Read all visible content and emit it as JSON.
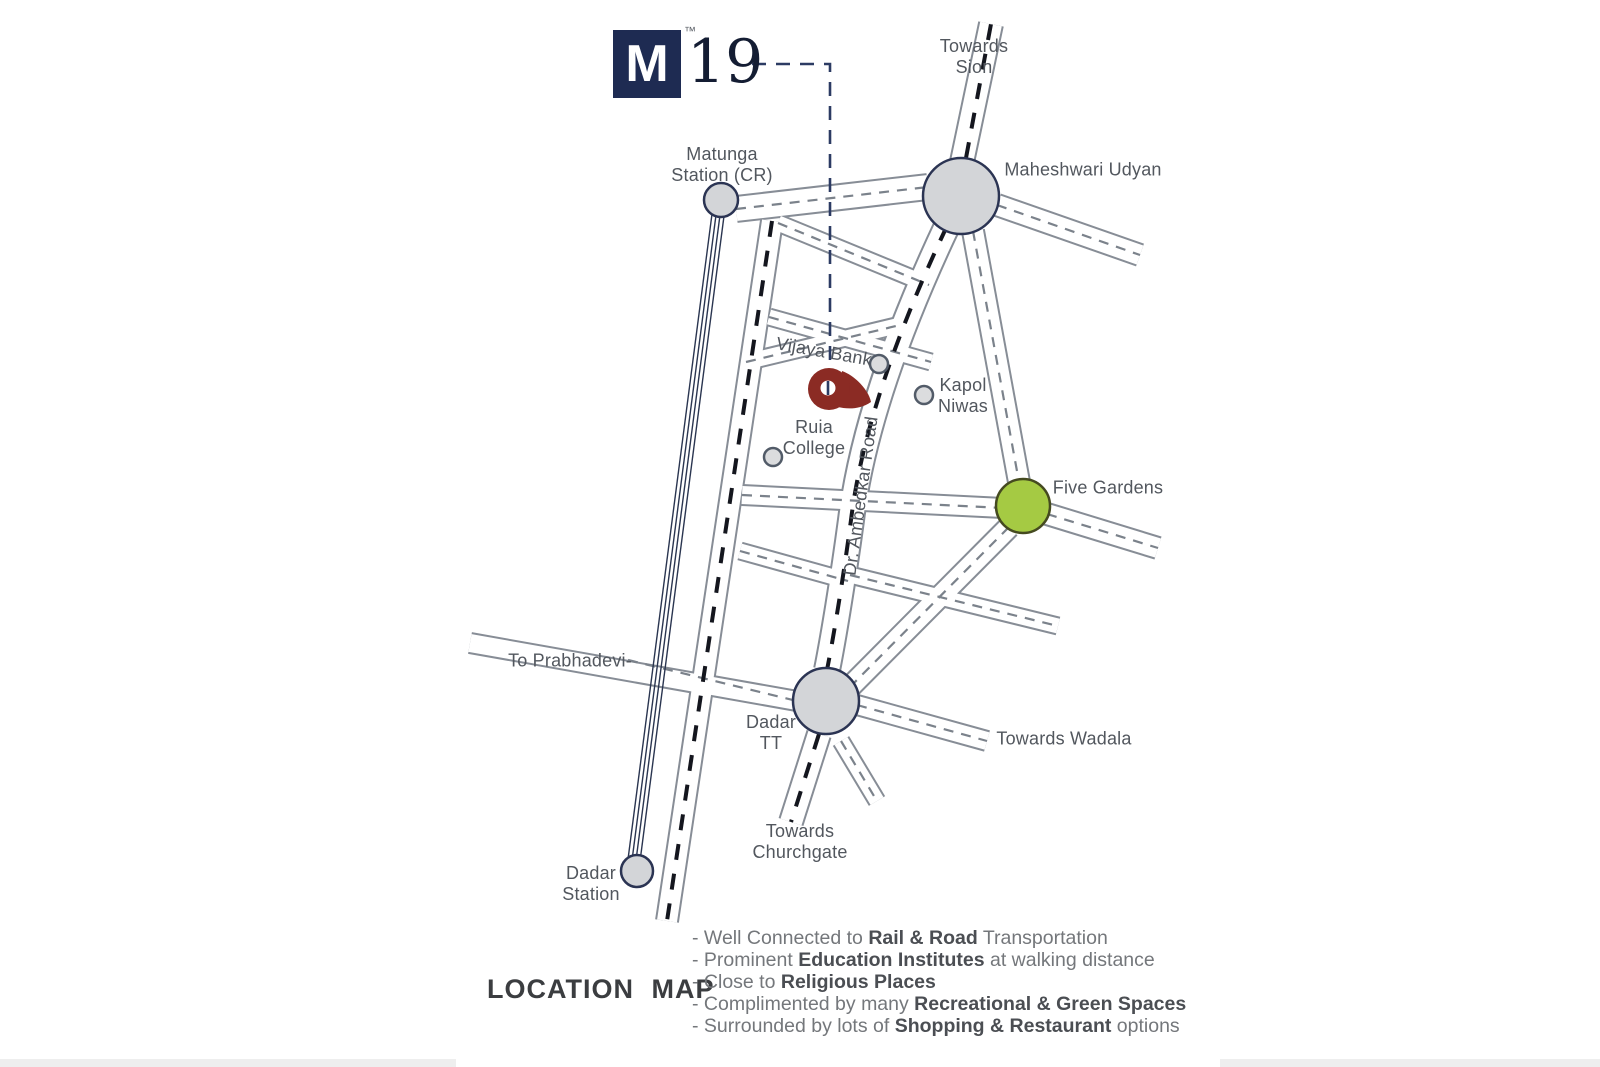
{
  "logo": {
    "m": "M",
    "tm": "™",
    "number": "19"
  },
  "map_labels": {
    "towards_sion": {
      "line1": "Towards",
      "line2": "Sion"
    },
    "matunga_station": {
      "line1": "Matunga",
      "line2": "Station (CR)"
    },
    "maheshwari_udyan": {
      "text": "Maheshwari Udyan"
    },
    "vijaya_bank": {
      "text": "Vijaya Bank"
    },
    "kapol_niwas": {
      "line1": "Kapol",
      "line2": "Niwas"
    },
    "ruia_college": {
      "line1": "Ruia",
      "line2": "College"
    },
    "ambedkar_road": {
      "text": "Dr. Ambedkar Road"
    },
    "five_gardens": {
      "text": "Five Gardens"
    },
    "to_prabhadevi": {
      "text": "To Prabhadevi-"
    },
    "dadar_tt": {
      "line1": "Dadar",
      "line2": "TT"
    },
    "towards_wadala": {
      "text": "Towards Wadala"
    },
    "towards_churchgate": {
      "line1": "Towards",
      "line2": "Churchgate"
    },
    "dadar_station": {
      "line1": "Dadar",
      "line2": "Station"
    }
  },
  "legend": {
    "title": "LOCATION MAP",
    "items": [
      {
        "segments": [
          {
            "t": "- Well Connected to ",
            "b": false
          },
          {
            "t": "Rail & Road",
            "b": true
          },
          {
            "t": " Transportation",
            "b": false
          }
        ]
      },
      {
        "segments": [
          {
            "t": "- Prominent ",
            "b": false
          },
          {
            "t": "Education Institutes",
            "b": true
          },
          {
            "t": " at walking distance",
            "b": false
          }
        ]
      },
      {
        "segments": [
          {
            "t": "- Close to ",
            "b": false
          },
          {
            "t": "Religious Places",
            "b": true
          }
        ]
      },
      {
        "segments": [
          {
            "t": "- Complimented by many ",
            "b": false
          },
          {
            "t": "Recreational & Green Spaces",
            "b": true
          }
        ]
      },
      {
        "segments": [
          {
            "t": "- Surrounded by lots of ",
            "b": false
          },
          {
            "t": "Shopping & Restaurant",
            "b": true
          },
          {
            "t": " options",
            "b": false
          }
        ]
      }
    ]
  },
  "colors": {
    "logo_navy": "#1e2b52",
    "pin_maroon": "#8b2b24",
    "node_gray_fill": "#d3d5d8",
    "node_navy_stroke": "#2b3453",
    "five_gardens_green": "#a5ca43",
    "road_casing_gray": "#878d96",
    "bold_dash_black": "#14161e",
    "thin_dash_gray": "#7b828b",
    "railway_navy": "#2a3550",
    "label_gray": "#52575e",
    "legend_text_gray": "#74777b",
    "legend_bold_gray": "#4b4e53",
    "title_gray": "#3b3d40",
    "bottom_strip_gray": "#eeeeee"
  }
}
